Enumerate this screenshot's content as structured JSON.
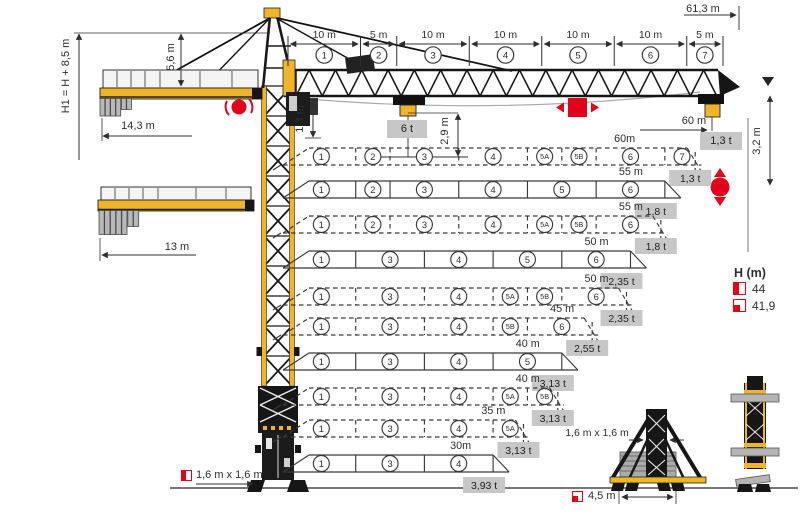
{
  "dimensions": {
    "total_height_label": "H1 = H + 8,5 m",
    "apex_height": "5,6 m",
    "counterjib_radius": "14,3 m",
    "counterjib_radius_short": "13 m",
    "jib_total_length": "61,3 m",
    "jib_foot_height": "1,3 m",
    "hook_clearance": "2,9 m",
    "max_capacity": "6 t",
    "tip_radius": "60 m",
    "tip_capacity": "1,3 t",
    "jib_tip_height": "3,2 m",
    "mast_section": "1,6 m x 1,6 m",
    "cross_base_mast": "1,6 m x 1,6 m",
    "cross_base_track": "4,5 m"
  },
  "jib_segments": [
    {
      "num": "1",
      "length_label": "10 m",
      "meters": 10
    },
    {
      "num": "2",
      "length_label": "5 m",
      "meters": 5
    },
    {
      "num": "3",
      "length_label": "10 m",
      "meters": 10
    },
    {
      "num": "4",
      "length_label": "10 m",
      "meters": 10
    },
    {
      "num": "5",
      "length_label": "10 m",
      "meters": 10
    },
    {
      "num": "6",
      "length_label": "10 m",
      "meters": 10
    },
    {
      "num": "7",
      "length_label": "5 m",
      "meters": 5
    }
  ],
  "segment_meters": {
    "1": 10,
    "2": 5,
    "3": 10,
    "4": 10,
    "5": 10,
    "5A": 5,
    "5B": 5,
    "6": 10,
    "7": 5
  },
  "configurations": [
    {
      "length_label": "60m",
      "tip_load": "1,3 t",
      "style": "dashed",
      "segments": [
        "1",
        "2",
        "3",
        "4",
        "5A",
        "5B",
        "6",
        "7"
      ]
    },
    {
      "length_label": "55 m",
      "tip_load": "1,8 t",
      "style": "solid",
      "segments": [
        "1",
        "2",
        "3",
        "4",
        "5",
        "6"
      ]
    },
    {
      "length_label": "55 m",
      "tip_load": "1,8 t",
      "style": "dashed",
      "segments": [
        "1",
        "2",
        "3",
        "4",
        "5A",
        "5B",
        "6"
      ]
    },
    {
      "length_label": "50 m",
      "tip_load": "2,35 t",
      "style": "solid",
      "segments": [
        "1",
        "3",
        "4",
        "5",
        "6"
      ]
    },
    {
      "length_label": "50 m",
      "tip_load": "2,35 t",
      "style": "dashed",
      "segments": [
        "1",
        "3",
        "4",
        "5A",
        "5B",
        "6"
      ]
    },
    {
      "length_label": "45 m",
      "tip_load": "2,55 t",
      "style": "dashed",
      "segments": [
        "1",
        "3",
        "4",
        "5B",
        "6"
      ]
    },
    {
      "length_label": "40 m",
      "tip_load": "3,13 t",
      "style": "solid",
      "segments": [
        "1",
        "3",
        "4",
        "5"
      ]
    },
    {
      "length_label": "40 m",
      "tip_load": "3,13 t",
      "style": "dashed",
      "segments": [
        "1",
        "3",
        "4",
        "5A",
        "5B"
      ]
    },
    {
      "length_label": "35 m",
      "tip_load": "3,13 t",
      "style": "dashed",
      "segments": [
        "1",
        "3",
        "4",
        "5A"
      ]
    },
    {
      "length_label": "30m",
      "tip_load": "3,93 t",
      "style": "solid",
      "segments": [
        "1",
        "3",
        "4"
      ]
    }
  ],
  "legend": {
    "title": "H (m)",
    "entries": [
      {
        "icon": "mast-anchor-icon",
        "value": "44"
      },
      {
        "icon": "cross-base-icon",
        "value": "41,9"
      }
    ]
  },
  "icons": {
    "slewing": "slewing-rotation-icon",
    "trolley_travel": "trolley-travel-icon",
    "hoist": "hook-hoist-icon",
    "mast_anchor": "mast-anchor-icon",
    "cross_base": "cross-base-icon"
  },
  "colors": {
    "crane_yellow": "#f0b429",
    "accent_red": "#e2001a",
    "badge_bg": "#c7c7c7",
    "line": "#3a3a3a"
  }
}
